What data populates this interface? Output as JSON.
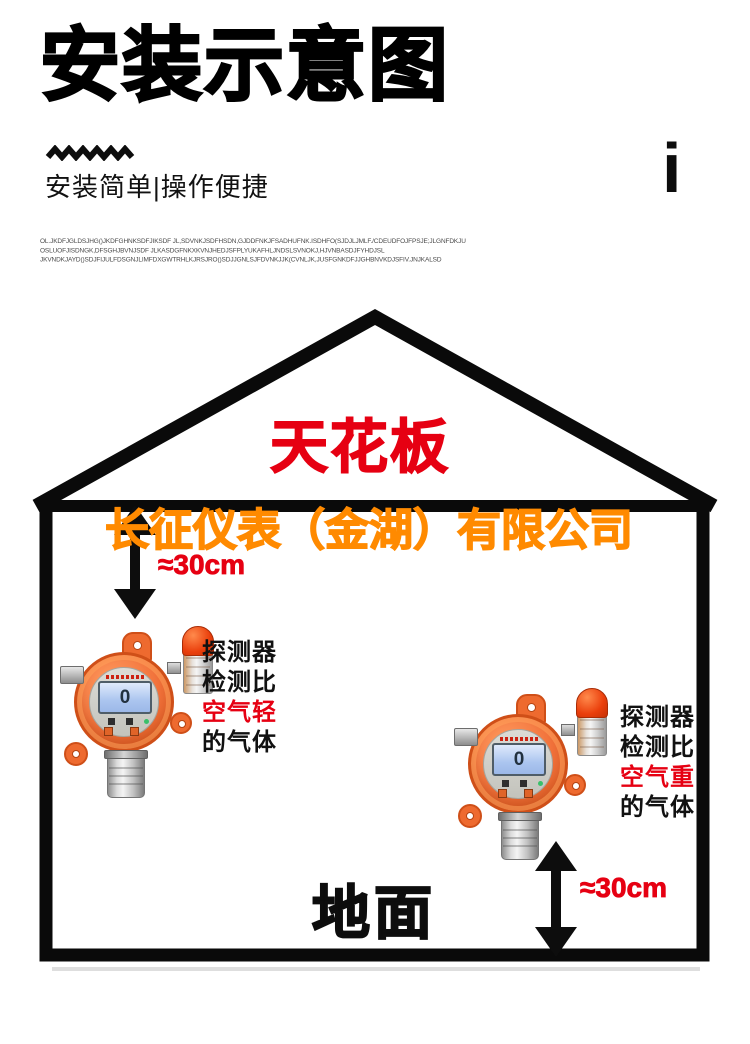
{
  "header": {
    "title": "安装示意图",
    "subtitle": "安装简单|操作便捷",
    "info_mark": "i",
    "watermark_lines": [
      "OL.JKDFJGLDSJHG()JKDFGHNKSDFJIKSDF JL,SDVNKJSDFHSDN,GJDDFNKJFSADHUFNK.ISDHFO(SJDJLJMLF./CDEUDFOJFPSJE;JLGNFDKJU",
      "OSLUOFJISDNGK,DFSGHJBVNJSDF JLKASDGFNKXKVNJHEDJSFPLYUKAFHLJNDSLSVNOKJ,HJVNBASDJFYHDJSL",
      "JKVNDKJAYD()SDJFIJULFDSGNJLIMFDXGWTRHLKJRSJRO()SDJJGNLSJFDVNKJJK(CVNLJK,JUSFGNKDFJJGHBNVKDJSFIV.JNJKALSD"
    ]
  },
  "house": {
    "ceiling_label": "天花板",
    "company_label": "长征仪表（金湖）有限公司",
    "ground_label": "地面"
  },
  "annotations": {
    "left_distance": "≈30cm",
    "right_distance": "≈30cm",
    "left_note_lines": [
      "探测器",
      "检测比",
      "空气轻",
      "的气体"
    ],
    "right_note_lines": [
      "探测器",
      "检测比",
      "空气重",
      "的气体"
    ]
  },
  "detector": {
    "lcd_value": "0"
  },
  "colors": {
    "accent_red": "#e60012",
    "accent_orange": "#ff8a00",
    "ink": "#0d0d0d",
    "detector_orange": "#ee6a2f"
  }
}
